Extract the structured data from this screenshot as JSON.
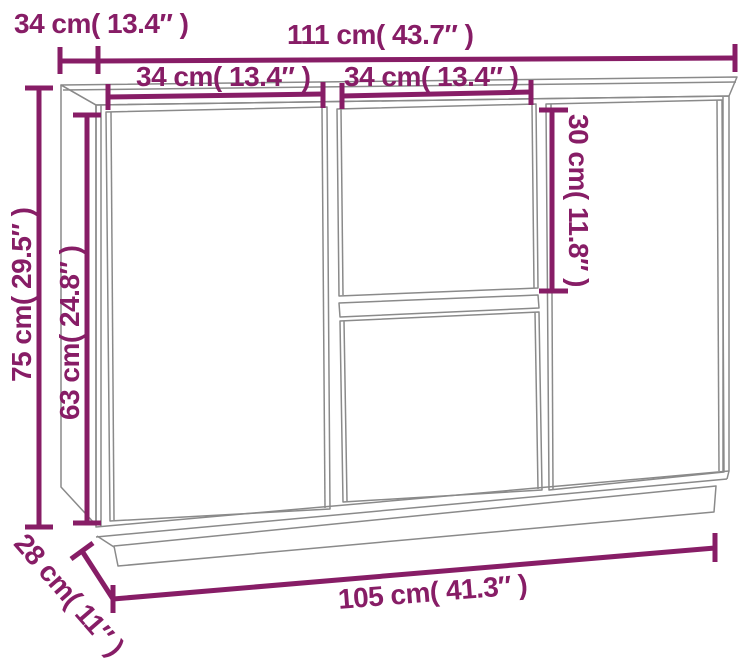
{
  "diagram": {
    "kind": "furniture-dimension-diagram",
    "subject": "sideboard-line-drawing",
    "colors": {
      "dimension_accent": "#871d66",
      "drawing_lines": "#8a8a8a",
      "background": "#ffffff"
    },
    "labels": {
      "depth_top": "34 cm( 13.4″ )",
      "width_total": "111 cm( 43.7″ )",
      "left_door_width": "34 cm( 13.4″ )",
      "drawer_width": "34 cm( 13.4″ )",
      "drawer_height": "30 cm( 11.8″ )",
      "total_height": "75 cm( 29.5″ )",
      "door_height": "63 cm( 24.8″ )",
      "depth_bottom": "28 cm( 11″ )",
      "width_bottom": "105 cm( 41.3″ )"
    }
  }
}
